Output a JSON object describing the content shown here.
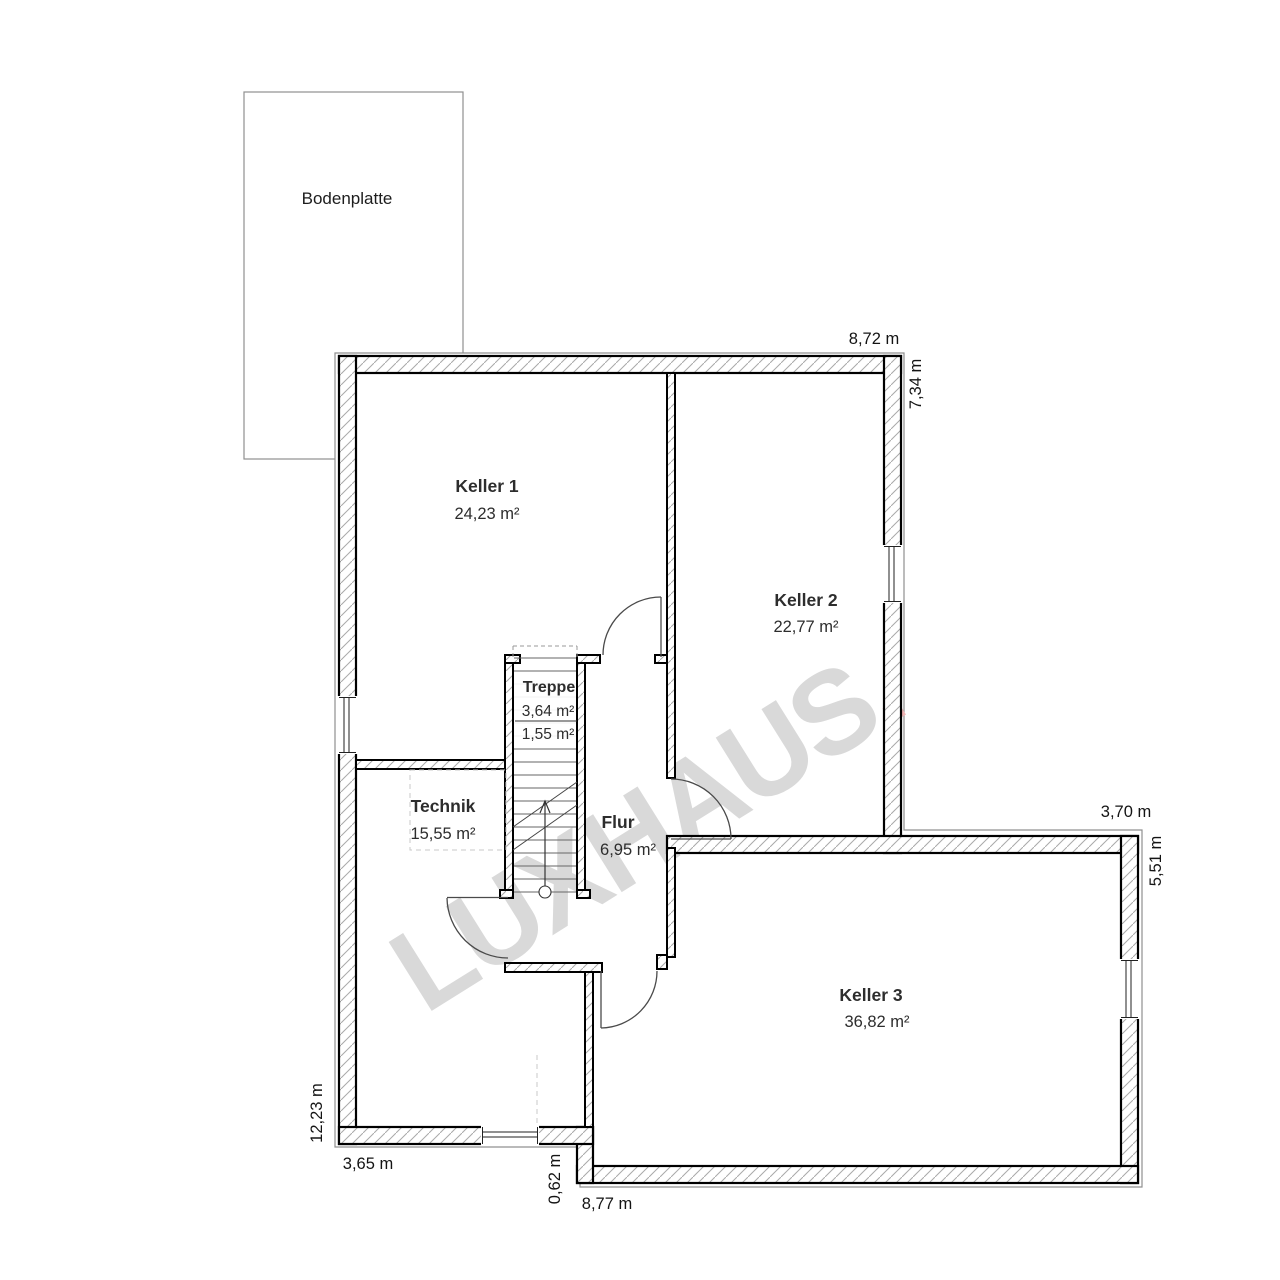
{
  "slab": {
    "label": "Bodenplatte"
  },
  "watermark": {
    "text": "LUXHAUS",
    "dot": ".",
    "text_color": "#d9d9d9",
    "dot_color": "#eeb3b3"
  },
  "rooms": {
    "keller1": {
      "name": "Keller 1",
      "area": "24,23 m²"
    },
    "keller2": {
      "name": "Keller 2",
      "area": "22,77 m²"
    },
    "keller3": {
      "name": "Keller 3",
      "area": "36,82 m²"
    },
    "technik": {
      "name": "Technik",
      "area": "15,55 m²"
    },
    "flur": {
      "name": "Flur",
      "area": "6,95 m²"
    },
    "treppe": {
      "name": "Treppe",
      "area_upper": "3,64 m²",
      "area_lower": "1,55 m²"
    }
  },
  "dimensions": {
    "top": "8,72 m",
    "right_upper": "7,34 m",
    "extension_top": "3,70 m",
    "extension_right": "5,51 m",
    "left": "12,23 m",
    "bottom_left": "3,65 m",
    "step": "0,62 m",
    "bottom": "8,77 m"
  }
}
